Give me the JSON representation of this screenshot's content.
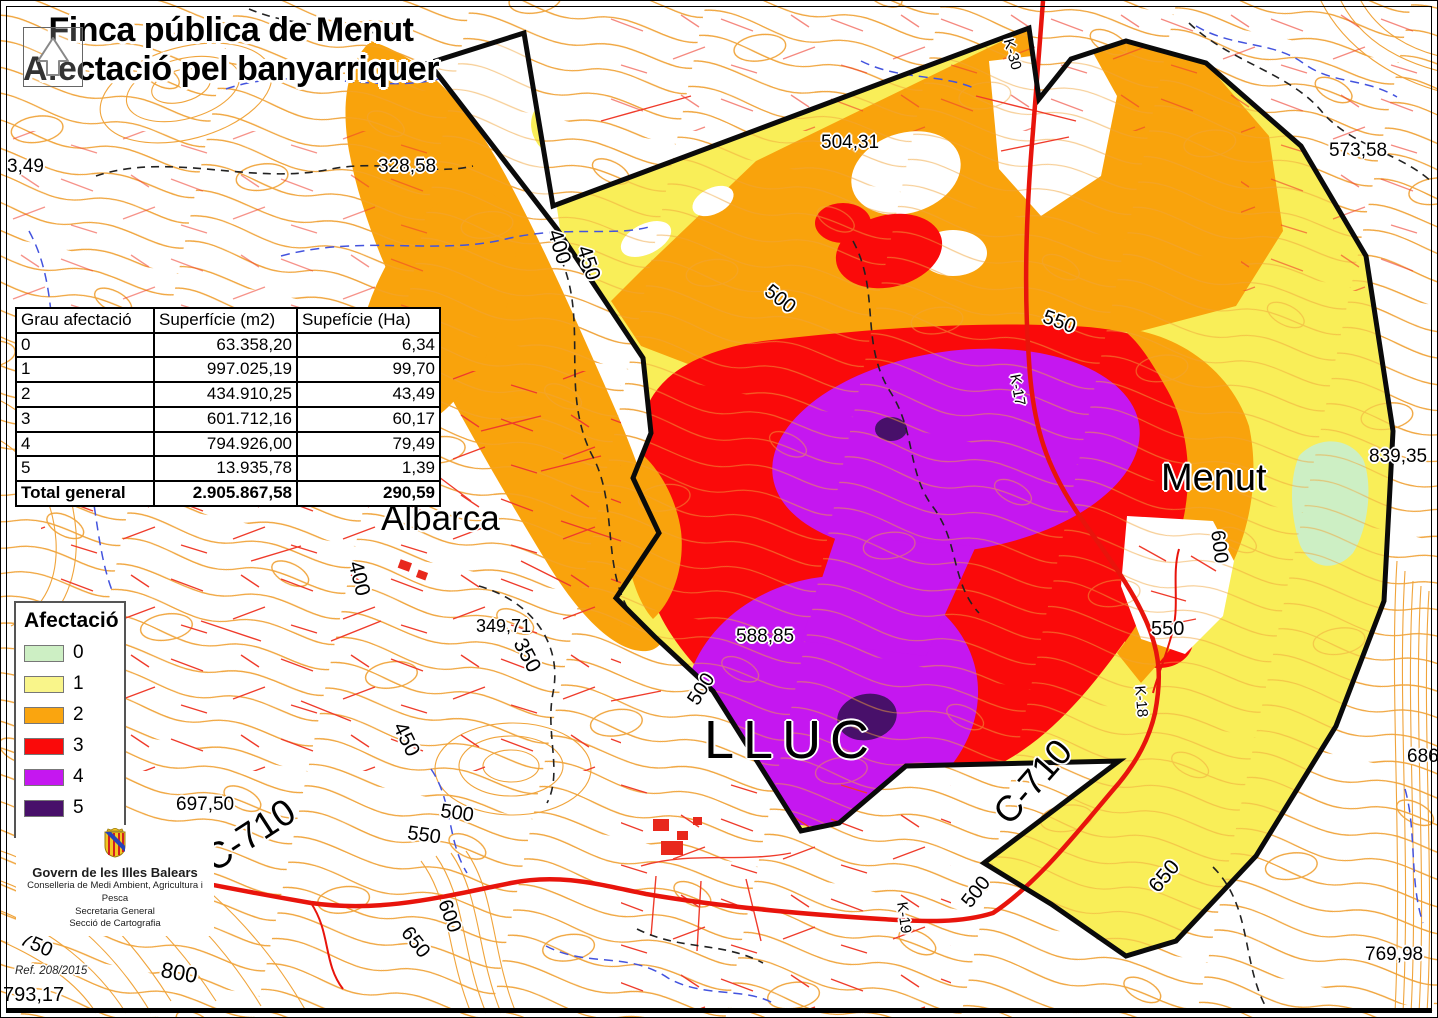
{
  "title": {
    "line1": "Finca pública de Menut",
    "line2": "Afectació pel banyarriquer"
  },
  "table": {
    "headers": [
      "Grau afectació",
      "Superfície (m2)",
      "Supefície (Ha)"
    ],
    "rows": [
      {
        "grade": "0",
        "m2": "63.358,20",
        "ha": "6,34"
      },
      {
        "grade": "1",
        "m2": "997.025,19",
        "ha": "99,70"
      },
      {
        "grade": "2",
        "m2": "434.910,25",
        "ha": "43,49"
      },
      {
        "grade": "3",
        "m2": "601.712,16",
        "ha": "60,17"
      },
      {
        "grade": "4",
        "m2": "794.926,00",
        "ha": "79,49"
      },
      {
        "grade": "5",
        "m2": "13.935,78",
        "ha": "1,39"
      },
      {
        "grade": "Total general",
        "m2": "2.905.867,58",
        "ha": "290,59"
      }
    ]
  },
  "legend": {
    "title": "Afectació",
    "items": [
      {
        "label": "0",
        "color": "#CDEFC4"
      },
      {
        "label": "1",
        "color": "#F9F58A"
      },
      {
        "label": "2",
        "color": "#FAA50F"
      },
      {
        "label": "3",
        "color": "#FA0A0A"
      },
      {
        "label": "4",
        "color": "#C517F0"
      },
      {
        "label": "5",
        "color": "#48106A"
      }
    ]
  },
  "agency": {
    "name": "Govern de les Illes Balears",
    "lines": [
      "Conselleria de Medi Ambient, Agricultura i Pesca",
      "Secretaria General",
      "Secció de Cartografia"
    ]
  },
  "ref": "Ref. 208/2015",
  "map_labels": [
    {
      "text": "3,49",
      "x": 6,
      "y": 156,
      "size": 19
    },
    {
      "text": "328,58",
      "x": 377,
      "y": 156,
      "size": 19
    },
    {
      "text": "504,31",
      "x": 820,
      "y": 132,
      "size": 19
    },
    {
      "text": "573,58",
      "x": 1328,
      "y": 140,
      "size": 19
    },
    {
      "text": "839,35",
      "x": 1368,
      "y": 446,
      "size": 19
    },
    {
      "text": "349,71",
      "x": 475,
      "y": 616,
      "size": 18
    },
    {
      "text": "588,85",
      "x": 735,
      "y": 626,
      "size": 19
    },
    {
      "text": "697,50",
      "x": 175,
      "y": 794,
      "size": 19
    },
    {
      "text": "769,98",
      "x": 1364,
      "y": 944,
      "size": 19
    },
    {
      "text": "793,17",
      "x": 2,
      "y": 984,
      "size": 20
    },
    {
      "text": "686",
      "x": 1406,
      "y": 746,
      "size": 19
    },
    {
      "text": "Albarca",
      "x": 380,
      "y": 500,
      "size": 35
    },
    {
      "text": "Menut",
      "x": 1160,
      "y": 458,
      "size": 38
    },
    {
      "text": "LLUC",
      "x": 703,
      "y": 712,
      "size": 54,
      "ls": 9
    },
    {
      "text": "C-710",
      "x": 196,
      "y": 846,
      "size": 37,
      "rot": -33
    },
    {
      "text": "C-710",
      "x": 986,
      "y": 806,
      "size": 36,
      "rot": -49
    },
    {
      "text": "400",
      "x": 563,
      "y": 226,
      "size": 21,
      "rot": 73
    },
    {
      "text": "450",
      "x": 592,
      "y": 242,
      "size": 21,
      "rot": 72
    },
    {
      "text": "500",
      "x": 772,
      "y": 280,
      "size": 20,
      "rot": 38
    },
    {
      "text": "550",
      "x": 1046,
      "y": 306,
      "size": 20,
      "rot": 20
    },
    {
      "text": "K-17",
      "x": 1021,
      "y": 372,
      "size": 15,
      "rot": 80
    },
    {
      "text": "K-30",
      "x": 1014,
      "y": 36,
      "size": 15,
      "rot": 74
    },
    {
      "text": "600",
      "x": 1226,
      "y": 528,
      "size": 20,
      "rot": 83
    },
    {
      "text": "550",
      "x": 1150,
      "y": 618,
      "size": 20
    },
    {
      "text": "400",
      "x": 364,
      "y": 558,
      "size": 21,
      "rot": 76
    },
    {
      "text": "350",
      "x": 527,
      "y": 634,
      "size": 21,
      "rot": 62
    },
    {
      "text": "450",
      "x": 407,
      "y": 718,
      "size": 21,
      "rot": 64
    },
    {
      "text": "500",
      "x": 441,
      "y": 800,
      "size": 20,
      "rot": 8
    },
    {
      "text": "550",
      "x": 408,
      "y": 822,
      "size": 20,
      "rot": 8
    },
    {
      "text": "600",
      "x": 452,
      "y": 896,
      "size": 20,
      "rot": 70
    },
    {
      "text": "650",
      "x": 412,
      "y": 922,
      "size": 20,
      "rot": 52
    },
    {
      "text": "500",
      "x": 957,
      "y": 898,
      "size": 20,
      "rot": -52
    },
    {
      "text": "K-19",
      "x": 908,
      "y": 900,
      "size": 15,
      "rot": 82
    },
    {
      "text": "K-18",
      "x": 1146,
      "y": 684,
      "size": 15,
      "rot": 85
    },
    {
      "text": "650",
      "x": 1144,
      "y": 882,
      "size": 21,
      "rot": -50
    },
    {
      "text": "750",
      "x": 24,
      "y": 928,
      "size": 20,
      "rot": 24
    },
    {
      "text": "800",
      "x": 162,
      "y": 958,
      "size": 22,
      "rot": 10
    },
    {
      "text": "500",
      "x": 683,
      "y": 697,
      "size": 20,
      "rot": -58
    }
  ]
}
